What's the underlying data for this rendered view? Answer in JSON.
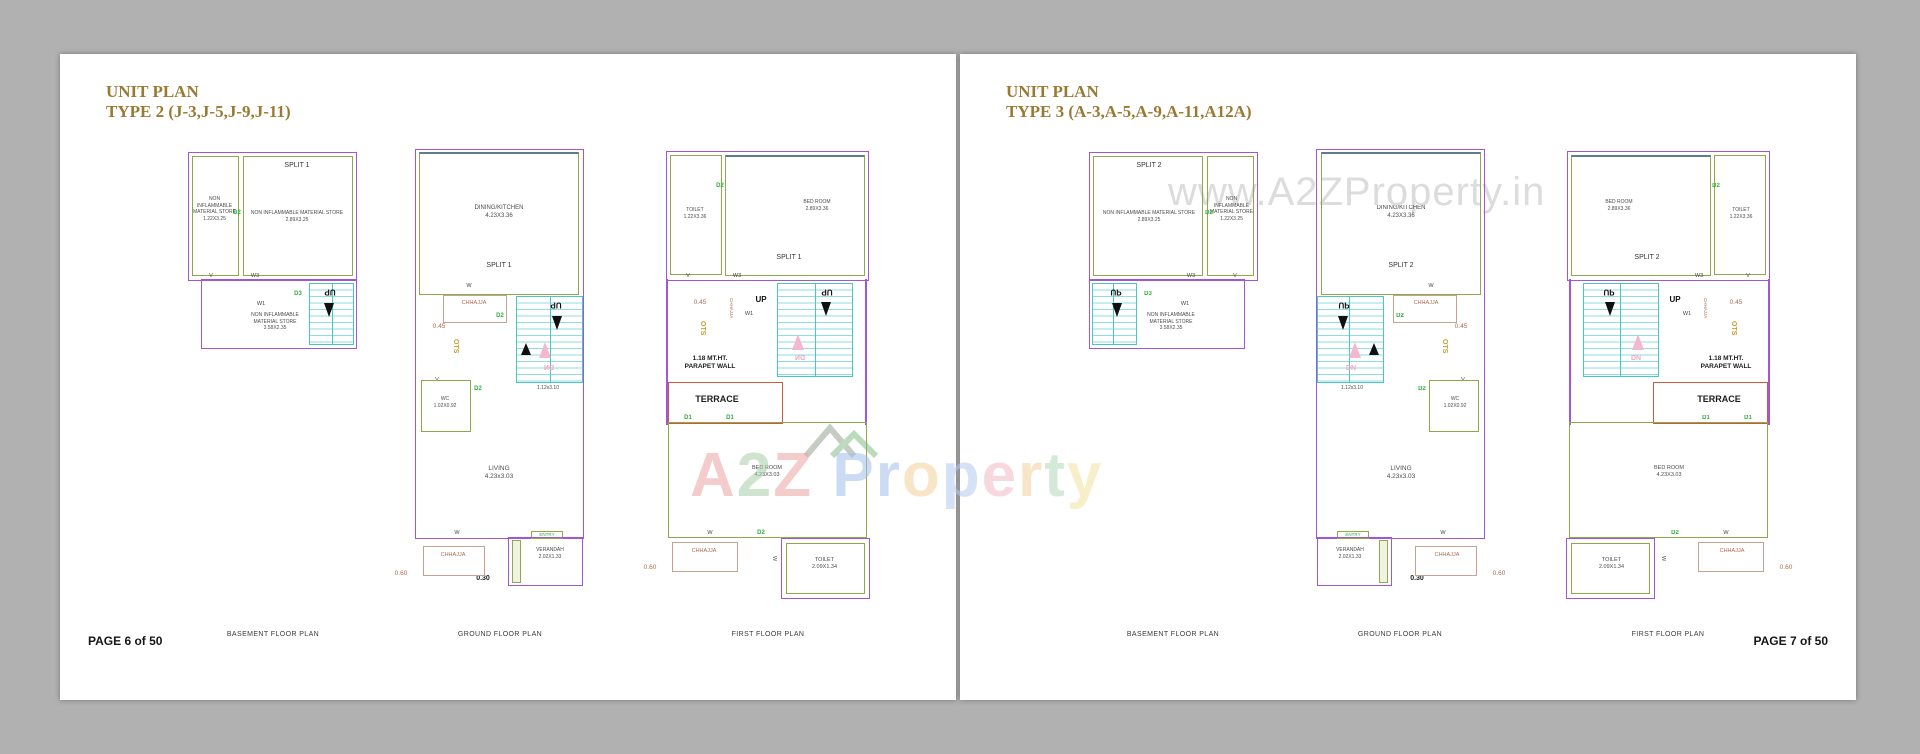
{
  "canvas_bg": "#b1b1b1",
  "page_bg": "#ffffff",
  "accents": {
    "wall_purple": "#a455d6",
    "room_green": "#8fa84c",
    "stair_cyan": "#49c7c7",
    "terrace_red": "#cd5a3c",
    "door_green": "#2fae3a",
    "ots_gold": "#c7a032",
    "chhajja_brown": "#ae6a52",
    "arrow_pink": "#f4b7d0",
    "title_brown": "#9a7a33"
  },
  "pages": {
    "left": {
      "title1": "UNIT PLAN",
      "title2": "TYPE 2 (J-3,J-5,J-9,J-11)",
      "split": "SPLIT 1",
      "footer": "PAGE 6 of 50"
    },
    "right": {
      "title1": "UNIT PLAN",
      "title2": "TYPE 3 (A-3,A-5,A-9,A-11,A12A)",
      "split": "SPLIT 2",
      "footer": "PAGE 7 of 50"
    }
  },
  "captions": {
    "basement": "BASEMENT FLOOR PLAN",
    "ground": "GROUND FLOOR PLAN",
    "first": "FIRST FLOOR PLAN"
  },
  "texts": {
    "store_small": "NON INFLAMMABLE\nMATERIAL STORE\n1.22X3.25",
    "store_wide": "NON INFLAMMABLE MATERIAL STORE\n2.89X3.25",
    "store_stair": "NON INFLAMMABLE\nMATERIAL STORE\n3.58X2.35",
    "dining": "DINING/KITCHEN\n4.23X3.36",
    "living": "LIVING\n4.23x3.03",
    "wc": "WC\n1.02X0.92",
    "verandah": "VERANDAH\n2.02X1.33",
    "toilet_top": "TOILET\n1.22X3.36",
    "bedroom_top": "BED ROOM\n2.89X3.36",
    "bedroom_main": "BED ROOM\n4.23X3.03",
    "toilet_small": "TOILET\n2.09X1.34",
    "terrace": "TERRACE",
    "parapet": "1.18 MT.HT.\nPARAPET WALL",
    "stair_dim": "1.12x3.10"
  },
  "marks": {
    "up": "UP",
    "dn": "DN",
    "d1": "D1",
    "d2": "D2",
    "d3": "D3",
    "w": "W",
    "w1": "W1",
    "w3": "W3",
    "v": "V",
    "ots": "OTS",
    "chhajja": "CHHAJJA",
    "entry": "ENTRY",
    "dim_030": "0.30",
    "dim_045": "0.45",
    "dim_060": "0.60"
  },
  "watermark": {
    "url_text": "www.A2ZProperty.in",
    "brand": [
      {
        "ch": "A",
        "color": "#eda3a3"
      },
      {
        "ch": "2",
        "color": "#a8cfa8"
      },
      {
        "ch": "Z",
        "color": "#eda3a3"
      },
      {
        "ch": " ",
        "color": "#ffffff"
      },
      {
        "ch": "P",
        "color": "#a3bfec"
      },
      {
        "ch": "r",
        "color": "#a3bfec"
      },
      {
        "ch": "o",
        "color": "#f3cf9b"
      },
      {
        "ch": "p",
        "color": "#b3c9ee"
      },
      {
        "ch": "e",
        "color": "#f3b9c6"
      },
      {
        "ch": "r",
        "color": "#f3cf9b"
      },
      {
        "ch": "t",
        "color": "#b2d9b8"
      },
      {
        "ch": "y",
        "color": "#f1e3a0"
      }
    ]
  }
}
